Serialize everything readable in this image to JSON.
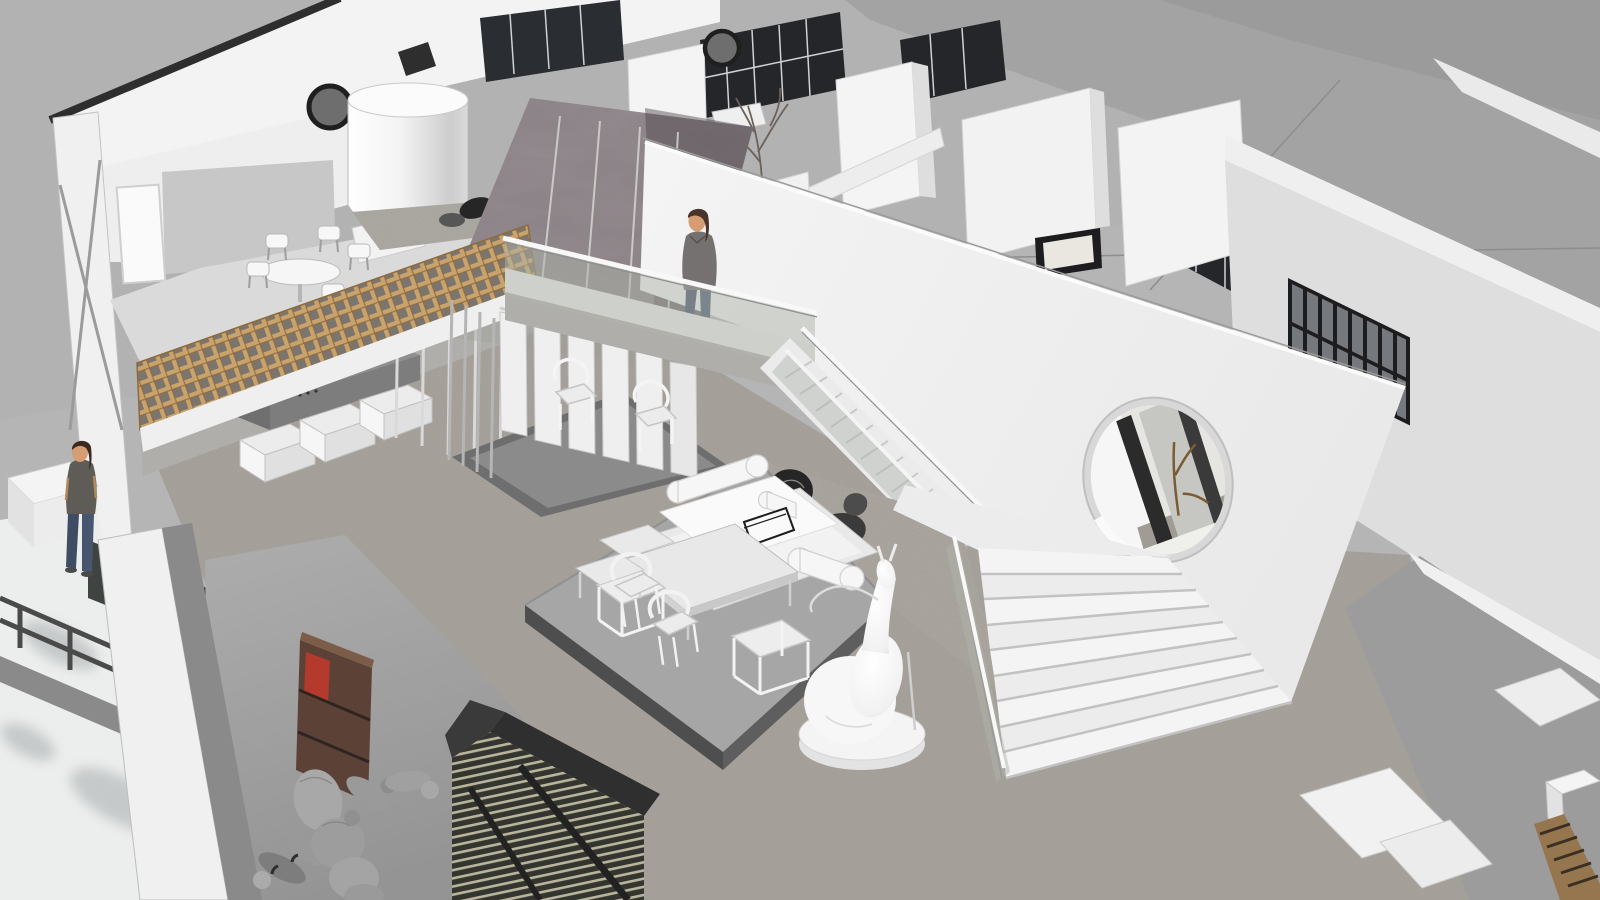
{
  "scene": {
    "title": "Axonometric cutaway rendering of a two-storey loft gallery interior",
    "render_style": "monochrome architectural 3D model",
    "areas": {
      "mezzanine": "upper lounge with round table, chairs and timber lattice balustrade",
      "bridge": "upper walkway with glass balustrade and standing figure",
      "feature_wall": "large white wall pierced by a circular window",
      "stairs": "switchback stair to a wide grand staircase",
      "lounge": "sunken platform with daybed, tables and horseshoe chairs",
      "booth": "slatted display booth with two chairs",
      "offices": "partitioned office rooms along the back with window walls",
      "exterior": "grey roof planes and industrial window wall"
    },
    "figures": [
      {
        "id": "woman-on-bridge",
        "top": "grey sweater",
        "bottom": "blue jeans"
      },
      {
        "id": "person-lower-left",
        "top": "dark top",
        "bottom": "blue jeans"
      },
      {
        "id": "artist-mannequin",
        "material": "grey jointed figure"
      },
      {
        "id": "deer-sculpture",
        "material": "white abstract sculpture on round plinth"
      }
    ],
    "props": [
      "rocks on lattice rail",
      "black rocks on mosaic carpet",
      "bare branch tree",
      "timber ladder",
      "wooden cabinet with red object",
      "white wall panels"
    ]
  },
  "palette": {
    "background": "#b5b5b5",
    "roof_grey": "#a3a3a3",
    "wall_white": "#f2f2f2",
    "wall_shade": "#dedede",
    "carpet": "#a7a29b",
    "mosaic": "#b3aea7",
    "lower_floor": "#9c9c9c",
    "glass": "#aeb4aa",
    "glazing_dark": "#24262a",
    "frame_dark": "#1d1d1f",
    "lattice_wood": "#c9a36b",
    "stone": "#8a8286",
    "platform": "#a6a6a6",
    "platform_edge": "#5e5e5e",
    "booth_floor": "#6e6e6e",
    "furniture_white": "#f5f5f5",
    "skin": "#d69c73",
    "hair": "#49332a",
    "sweater": "#757170",
    "jeans": "#3e4d63",
    "mannequin": "#a8a8a8",
    "sculpture": "#f7f7f7",
    "wood_cabinet": "#5c4236",
    "accent_red": "#b53a2e",
    "rock_dark": "#262626",
    "slat_structure": "#35352f",
    "slat_gap": "#b9b59d",
    "ladder_wood": "#96764e",
    "roofline_dark": "#2e2e2e"
  }
}
